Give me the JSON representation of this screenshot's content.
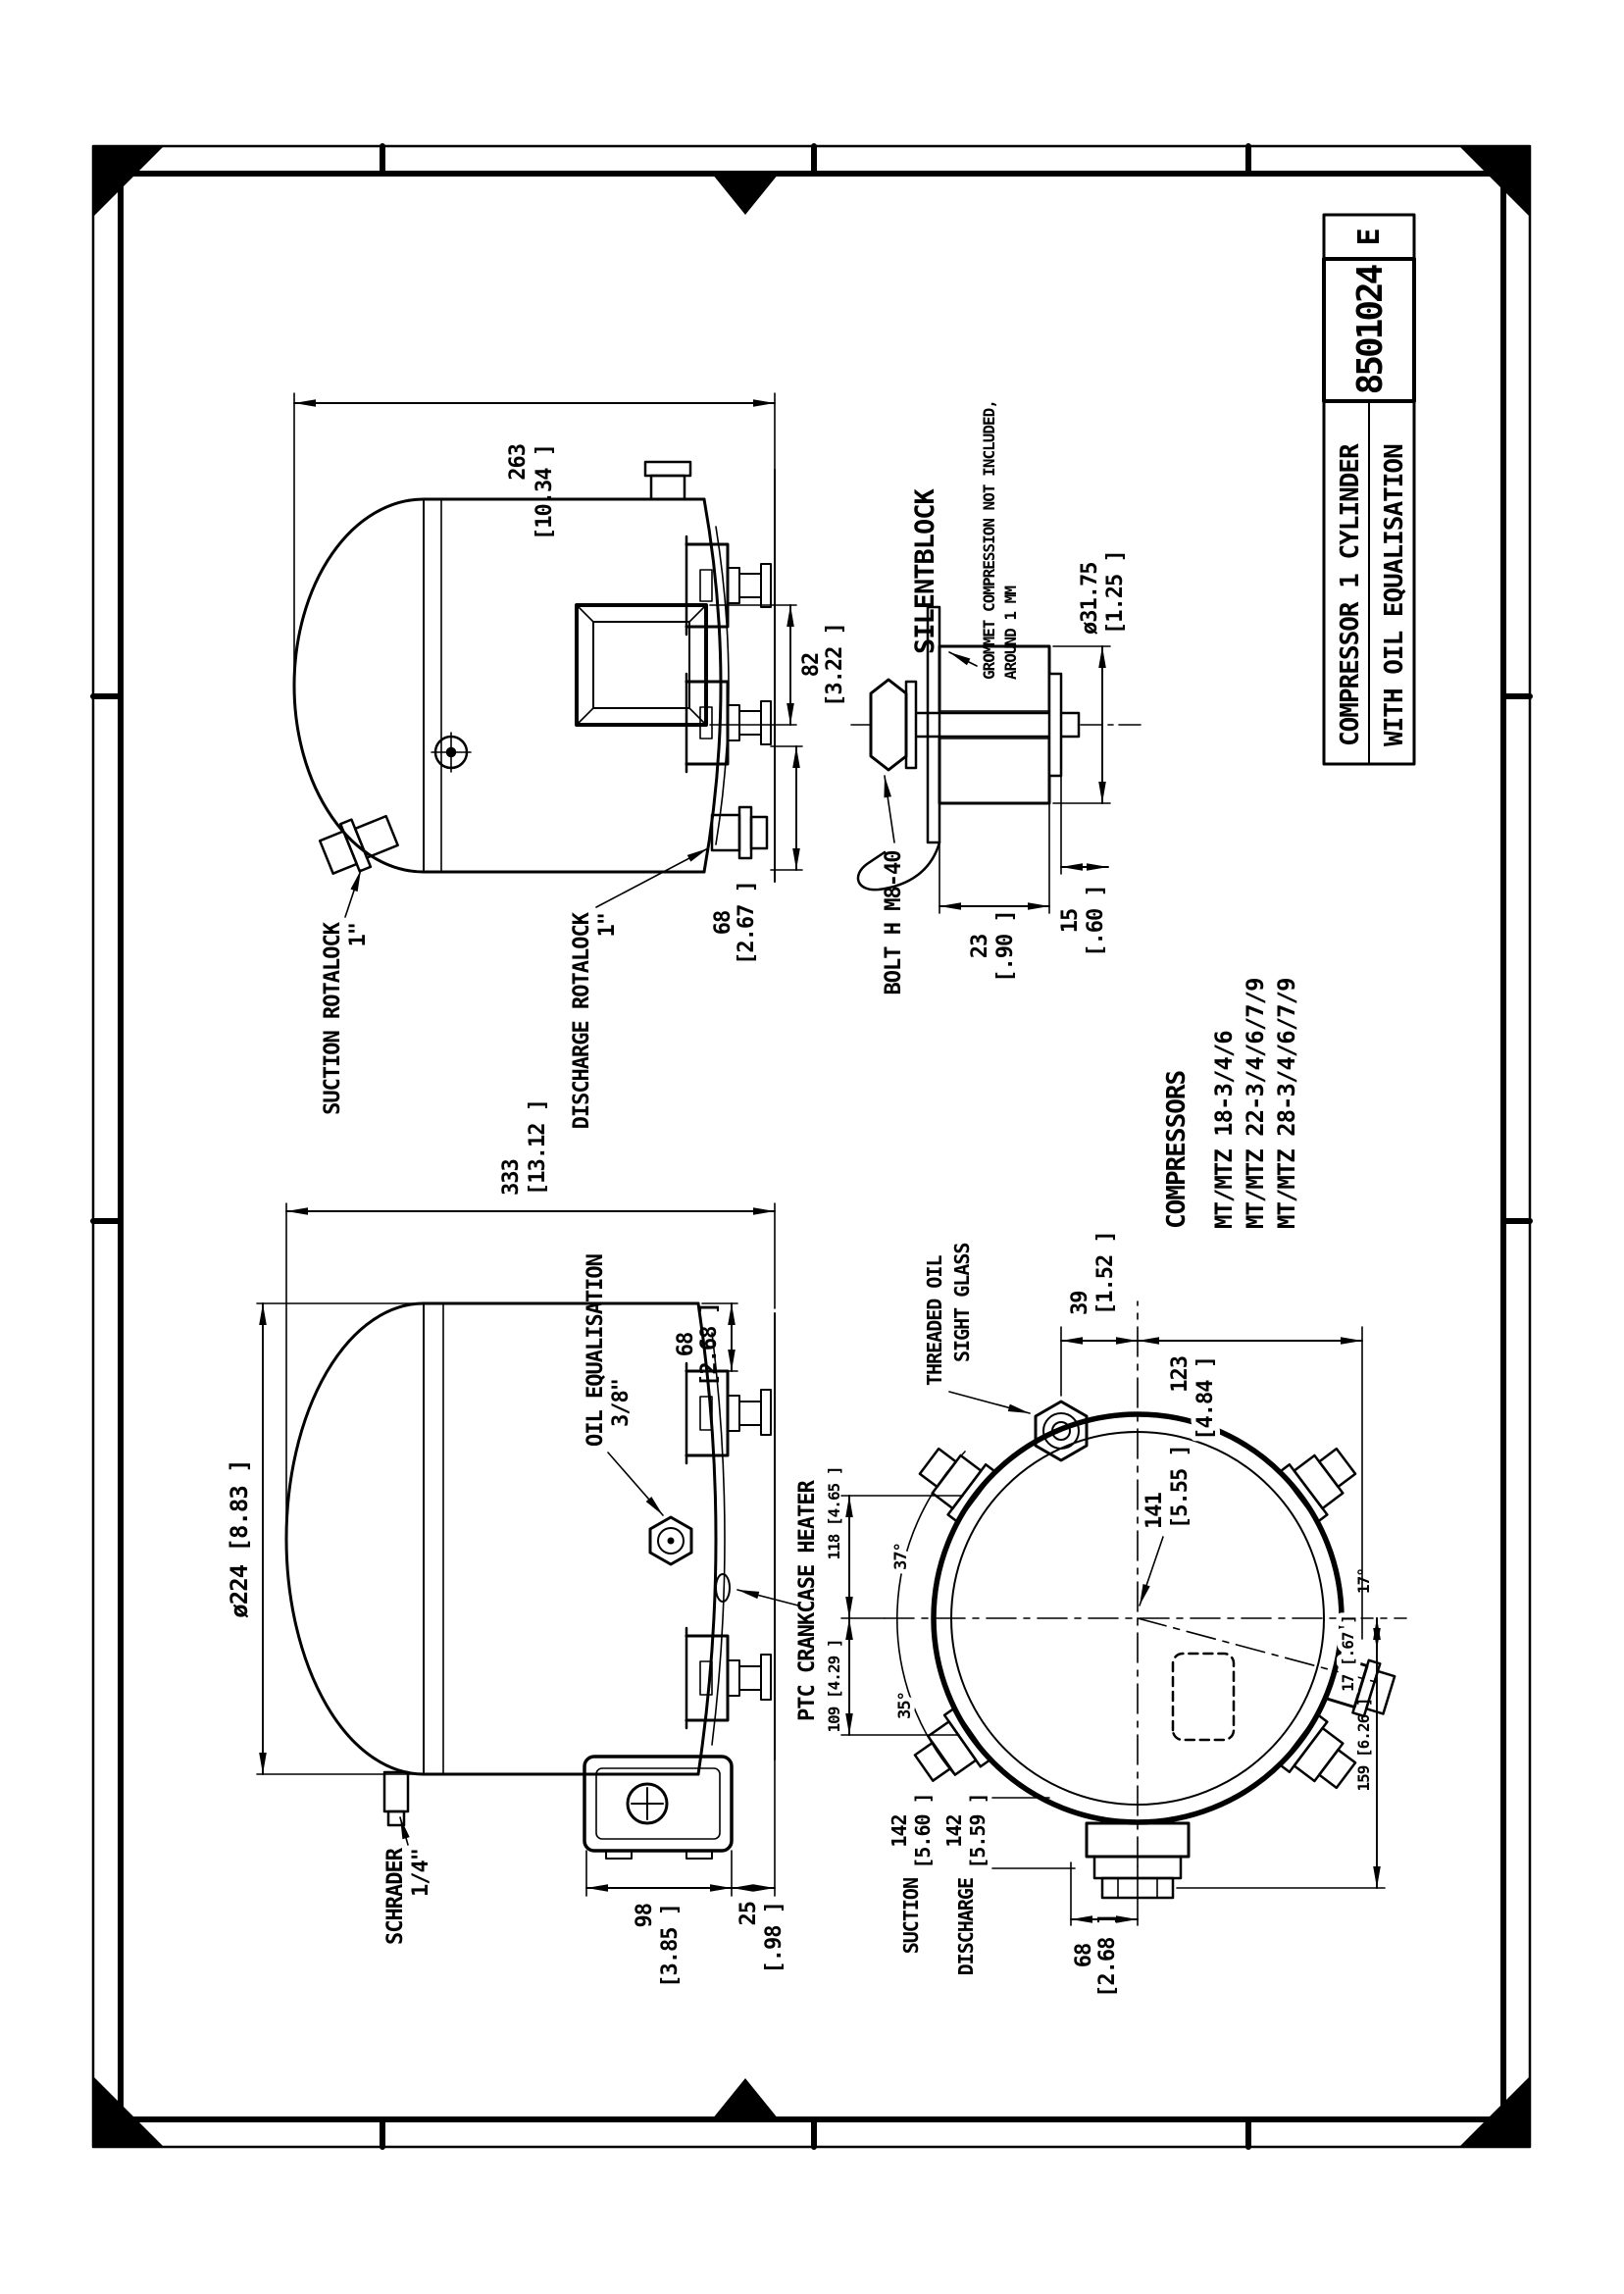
{
  "sheet": {
    "title": "COMPRESSOR 1 CYLINDER",
    "subtitle": "WITH OIL EQUALISATION",
    "drawing_number": "8501024",
    "revision": "E"
  },
  "compressors": {
    "heading": "COMPRESSORS",
    "models": [
      "MT/MTZ 18-3/4/6",
      "MT/MTZ 22-3/4/6/7/9",
      "MT/MTZ 28-3/4/6/7/9"
    ]
  },
  "view_side_a": {
    "suction_label": "SUCTION ROTALOCK",
    "suction_size": "1\"",
    "discharge_label": "DISCHARGE ROTALOCK",
    "discharge_size": "1\"",
    "dim_length_mm": "263",
    "dim_length_in": "[10.34 ]",
    "dim_box_mm": "82",
    "dim_box_in": "[3.22 ]",
    "dim_foot_mm": "68",
    "dim_foot_in": "[2.67 ]"
  },
  "detail_silentblock": {
    "heading": "SILENTBLOCK",
    "note1": "GROMMET COMPRESSION NOT INCLUDED,",
    "note2": "AROUND 1 MM",
    "bolt_label": "BOLT H M8-40",
    "dia_mm": "ø31.75",
    "dia_in": "[1.25 ]",
    "dim_a_mm": "23",
    "dim_a_in": "[.90 ]",
    "dim_b_mm": "15",
    "dim_b_in": "[.60 ]"
  },
  "view_side_b": {
    "dim_length_mm": "333",
    "dim_length_in": "[13.12 ]",
    "dim_dia": "ø224 [8.83 ]",
    "oil_eq_label": "OIL EQUALISATION",
    "oil_eq_size": "3/8\"",
    "heater_label": "PTC CRANKCASE HEATER",
    "schrader_label": "SCHRADER",
    "schrader_size": "1/4\"",
    "dim_foot_mm": "68",
    "dim_foot_in": "[2.68 ]",
    "dim_a_mm": "98",
    "dim_a_in": "[3.85 ]",
    "dim_b_mm": "25",
    "dim_b_in": "[.98 ]"
  },
  "view_top": {
    "sight_glass_1": "THREADED OIL",
    "sight_glass_2": "SIGHT GLASS",
    "dim_39_mm": "39",
    "dim_39_in": "[1.52 ]",
    "dim_123_mm": "123",
    "dim_123_in": "[4.84 ]",
    "dim_141_mm": "141",
    "dim_141_in": "[5.55 ]",
    "dim_118": "118  [4.65 ]",
    "dim_109": "109  [4.29 ]",
    "angle_right": "37°",
    "angle_left": "35°",
    "angle_bottom": "17°",
    "dim_17": "17 [.67 ]",
    "dim_159": "159 [6.26 ]",
    "dim_68_mm": "68",
    "dim_68_in": "[2.68 ]",
    "suction_label": "SUCTION",
    "suction_mm": "142",
    "suction_in": "[5.60 ]",
    "discharge_label": "DISCHARGE",
    "discharge_mm": "142",
    "discharge_in": "[5.59 ]"
  }
}
